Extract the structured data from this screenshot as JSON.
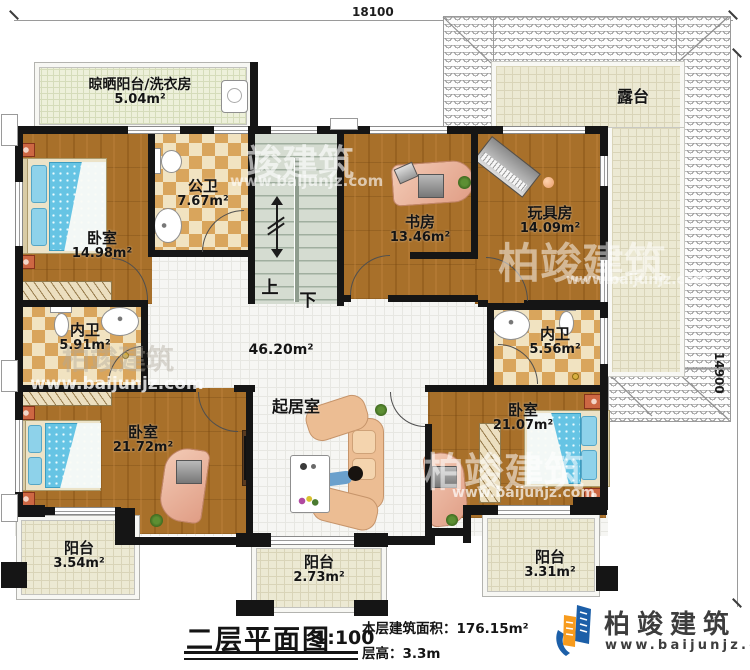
{
  "dimensions": {
    "top": "18100",
    "right": "14900"
  },
  "rooms": {
    "laundry": {
      "name": "晾晒阳台/洗衣房",
      "area": "5.04m²"
    },
    "public_bath": {
      "name": "公卫",
      "area": "7.67m²"
    },
    "bedroom_left": {
      "name": "卧室",
      "area": "14.98m²"
    },
    "study": {
      "name": "书房",
      "area": "13.46m²"
    },
    "toy_room": {
      "name": "玩具房",
      "area": "14.09m²"
    },
    "terrace": {
      "name": "露台"
    },
    "bath_left": {
      "name": "内卫",
      "area": "5.91m²"
    },
    "bath_right": {
      "name": "内卫",
      "area": "5.56m²"
    },
    "living": {
      "name": "起居室",
      "area": "46.20m²"
    },
    "bedroom_bl": {
      "name": "卧室",
      "area": "21.72m²"
    },
    "bedroom_br": {
      "name": "卧室",
      "area": "21.07m²"
    },
    "balcony_left": {
      "name": "阳台",
      "area": "3.54m²"
    },
    "balcony_center": {
      "name": "阳台",
      "area": "2.73m²"
    },
    "balcony_right": {
      "name": "阳台",
      "area": "3.31m²"
    }
  },
  "stairs": {
    "up": "上",
    "down": "下"
  },
  "title_block": {
    "title": "二层平面图",
    "scale": "1:100",
    "area_line": "本层建筑面积：176.15m²",
    "height_line": "层高：3.3m"
  },
  "branding": {
    "name": "柏竣建筑",
    "url": "www.baijunjz.com"
  },
  "watermarks": {
    "wm1": {
      "text": "竣建筑",
      "url": "www.baijunjz.com"
    },
    "wm2": {
      "text": "柏竣建筑",
      "url": "www.baijunjz.com"
    },
    "wm3": {
      "text": "柏竣建筑",
      "url": "www.baijunjz.com"
    },
    "wm4": {
      "text": "柏竣建筑",
      "url": "www.baijunjz.com"
    }
  },
  "colors": {
    "wall": "#151515",
    "wood": "#a8702a",
    "tile_tan": "#d9a55c",
    "tile_cream": "#f1e3c1",
    "hall_tile": "#f6f6f3",
    "terrace_floor": "#ece9d3",
    "stairs": "#d5dcd1",
    "bed_blue": "#66c4e4",
    "sofa_tan": "#ecbd93",
    "logo_blue": "#1c5fa8",
    "logo_orange": "#f79b1d"
  }
}
